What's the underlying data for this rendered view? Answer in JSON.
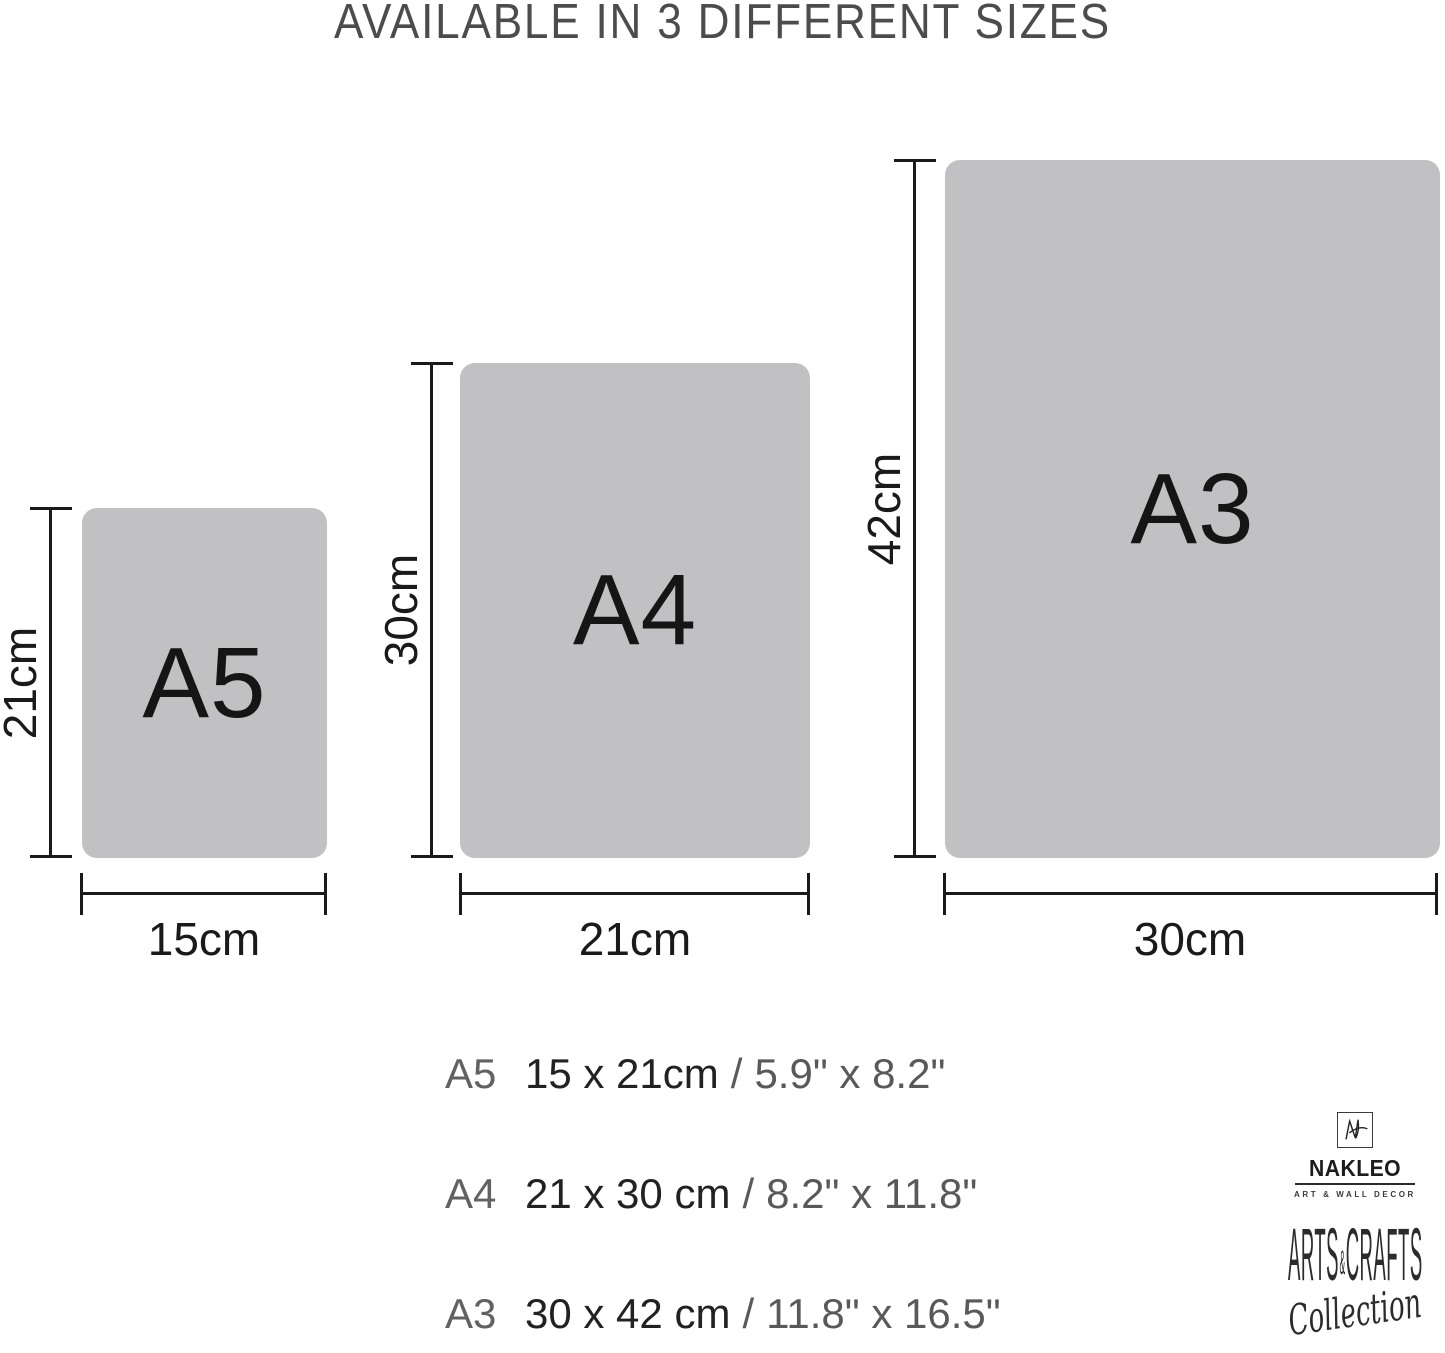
{
  "title": "AVAILABLE IN 3 DIFFERENT SIZES",
  "sizes": [
    {
      "code": "A5",
      "height_label": "21cm",
      "width_label": "15cm"
    },
    {
      "code": "A4",
      "height_label": "30cm",
      "width_label": "21cm"
    },
    {
      "code": "A3",
      "height_label": "42cm",
      "width_label": "30cm"
    }
  ],
  "legend": {
    "separator": "/",
    "rows": [
      {
        "code": "A5",
        "metric": "15 x 21cm",
        "imperial": "5.9\" x 8.2\""
      },
      {
        "code": "A4",
        "metric": "21 x 30 cm",
        "imperial": "8.2\" x 11.8\""
      },
      {
        "code": "A3",
        "metric": "30 x 42 cm",
        "imperial": "11.8\" x 16.5\""
      }
    ]
  },
  "brand": {
    "monogram": "NL",
    "name": "NAKLEO",
    "tagline": "ART & WALL DECOR",
    "collection": {
      "part1": "ARTS",
      "amp": "&",
      "part2": "CRAFTS",
      "script": "Collection"
    }
  },
  "colors": {
    "panel_gray": "#c1c0c2",
    "dimension_line": "#1a1a1a",
    "title_text": "#4c4c4e",
    "panel_label": "#151515",
    "legend_code": "#626262",
    "legend_metric": "#222222",
    "legend_imperial": "#595959",
    "brand_ink": "#2b2b2b"
  }
}
